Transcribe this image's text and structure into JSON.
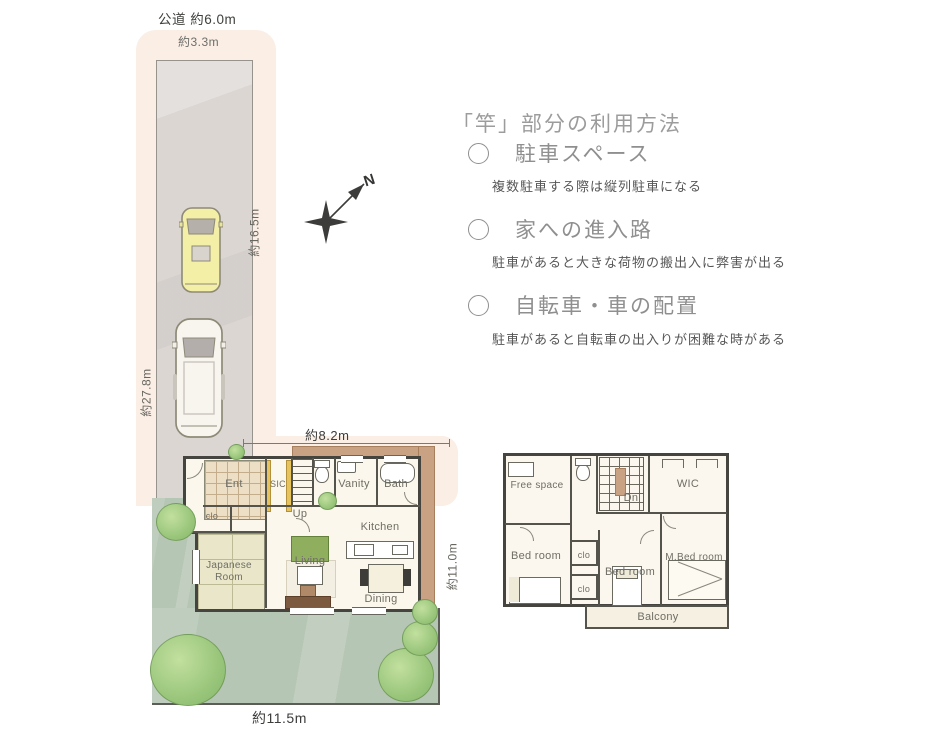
{
  "site": {
    "road_label": "公道 約6.0m",
    "width_label": "約3.3m",
    "strip_right_label": "約16.5m",
    "strip_left_label": "約27.8m",
    "compass_n": "N"
  },
  "usage_panel": {
    "heading": "「竿」部分の利用方法",
    "items": [
      {
        "title": "駐車スペース",
        "note": "複数駐車する際は縦列駐車になる"
      },
      {
        "title": "家への進入路",
        "note": "駐車があると大きな荷物の搬出入に弊害が出る"
      },
      {
        "title": "自転車・車の配置",
        "note": "駐車があると自転車の出入りが困難な時がある"
      }
    ]
  },
  "floor1": {
    "dim_top": "約8.2m",
    "dim_right": "約11.0m",
    "dim_bottom": "約11.5m",
    "ent": "Ent",
    "sic": "SIC",
    "up": "Up",
    "vanity": "Vanity",
    "bath": "Bath",
    "clo": "clo",
    "japanese_room": "Japanese Room",
    "living": "Living",
    "kitchen": "Kitchen",
    "dining": "Dining"
  },
  "floor2": {
    "free_space": "Free space",
    "dn": "Dn",
    "wic": "WIC",
    "bedroom_left": "Bed room",
    "clo_upper": "clo",
    "clo_lower": "clo",
    "bedroom_center": "Bed room",
    "m_bedroom": "M.Bed room",
    "balcony": "Balcony"
  },
  "colors": {
    "highlight_pink": "#faeee5",
    "pavement_gray": "#dbd6d2",
    "garden_green": "#b6c6b5",
    "tatami": "#e9e6c9",
    "eave_tan": "#c9a183",
    "car_yellow": "#f3efa6",
    "wall_dark": "#45443e"
  }
}
